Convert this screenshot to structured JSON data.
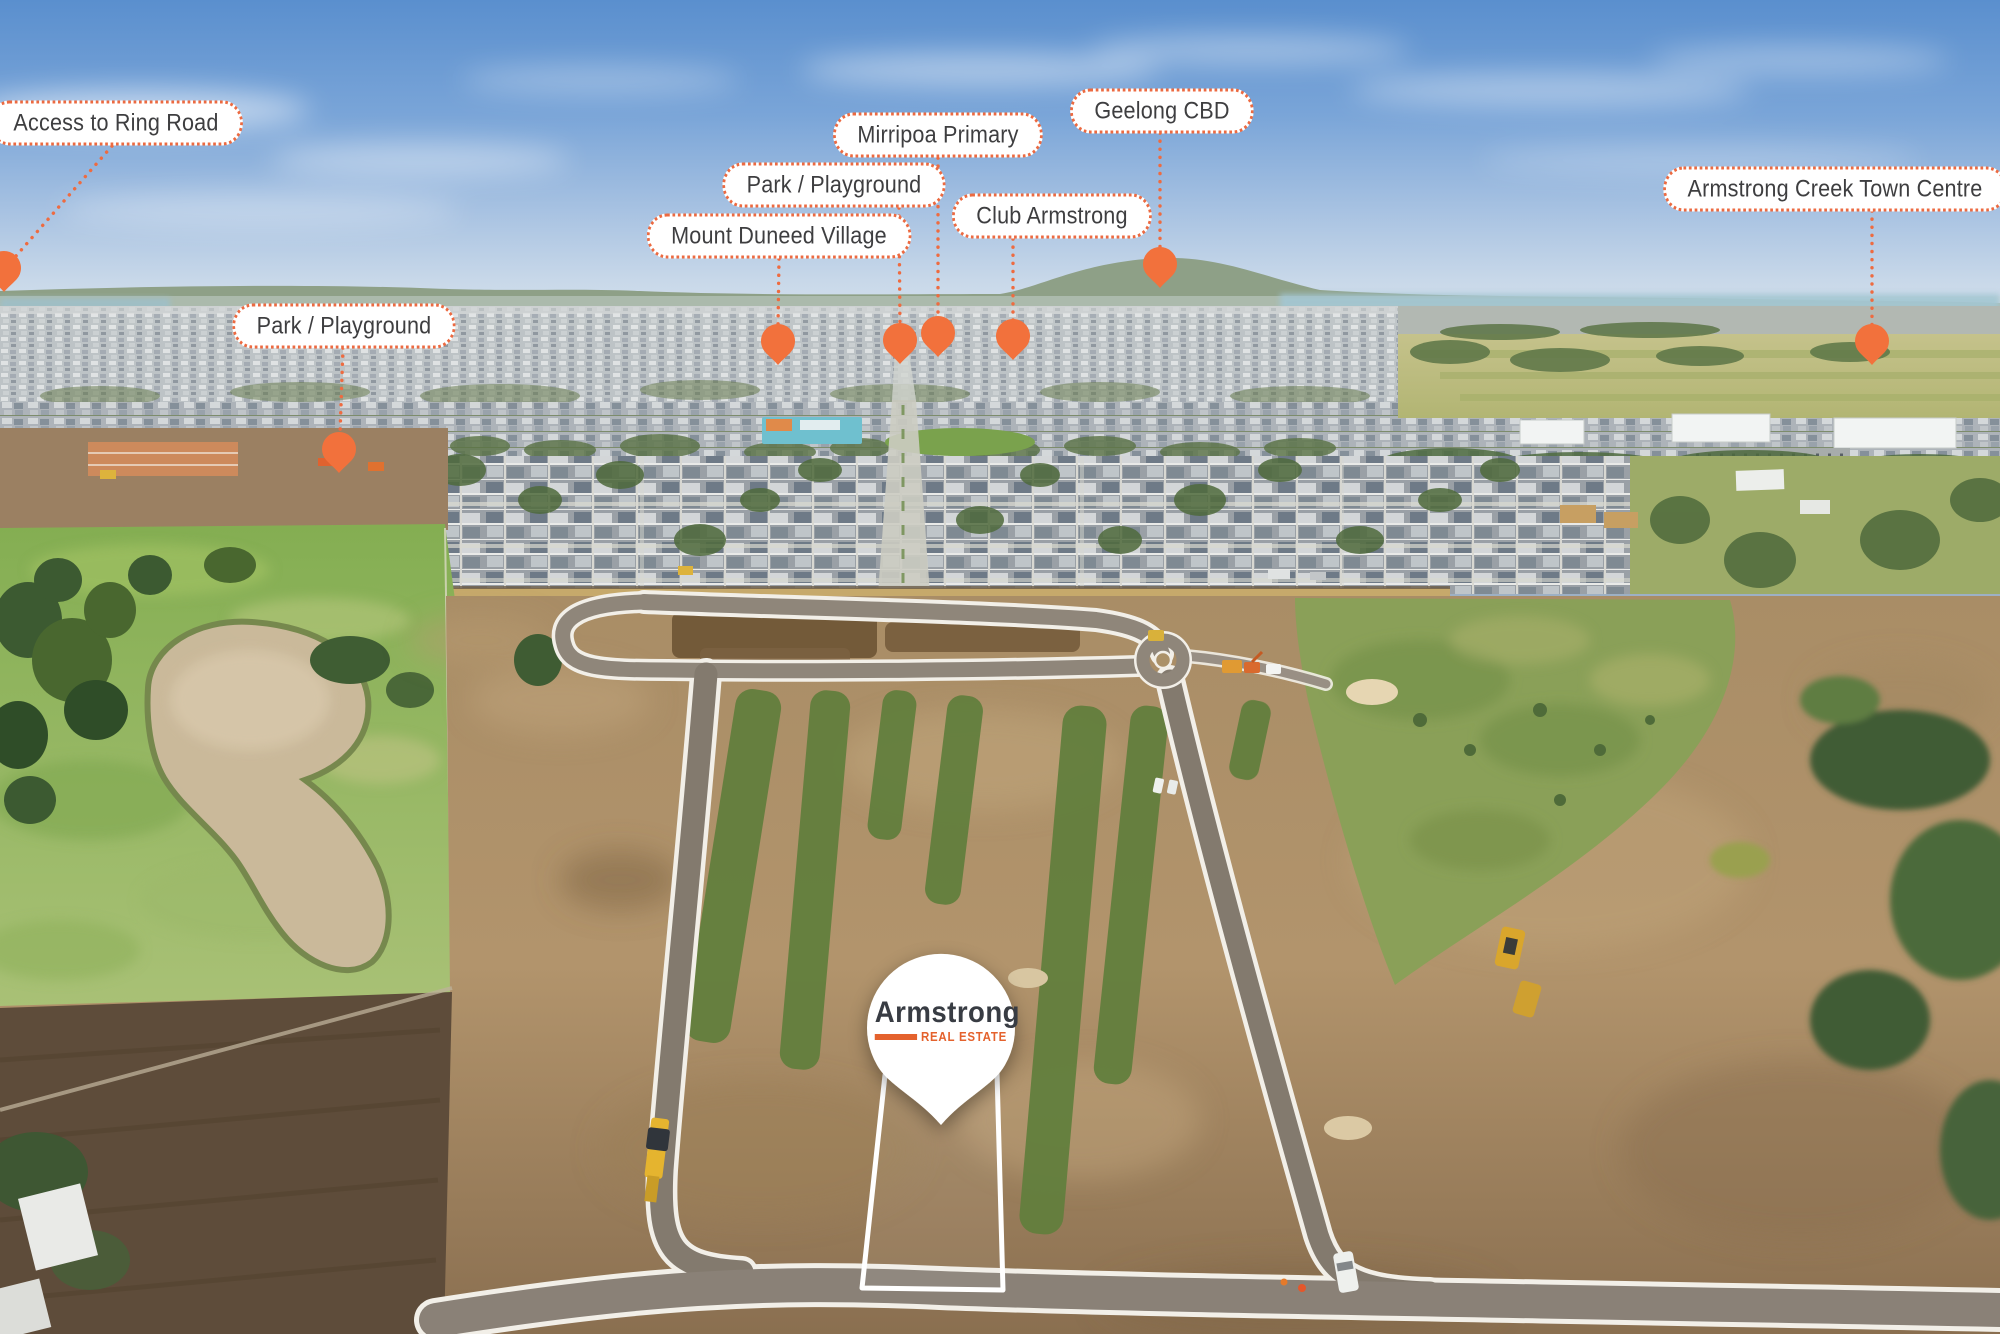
{
  "page": {
    "type": "aerial-development-marketing-photo"
  },
  "brand": {
    "name": "Armstrong",
    "tagline": "REAL ESTATE"
  },
  "map_labels": {
    "ring_road": "Access to Ring Road",
    "park_playground_west": "Park / Playground",
    "mount_duneed_village": "Mount Duneed Village",
    "park_playground_central": "Park / Playground",
    "mirripoa_primary": "Mirripoa Primary",
    "club_armstrong": "Club Armstrong",
    "geelong_cbd": "Geelong CBD",
    "town_centre": "Armstrong Creek Town Centre"
  },
  "colors": {
    "pin_orange": "#f2713c",
    "label_border": "#ec6a41",
    "label_text": "#3e3e40",
    "logo_charcoal": "#383c43",
    "logo_orange": "#e4622d",
    "lot_outline": "#ffffff"
  }
}
